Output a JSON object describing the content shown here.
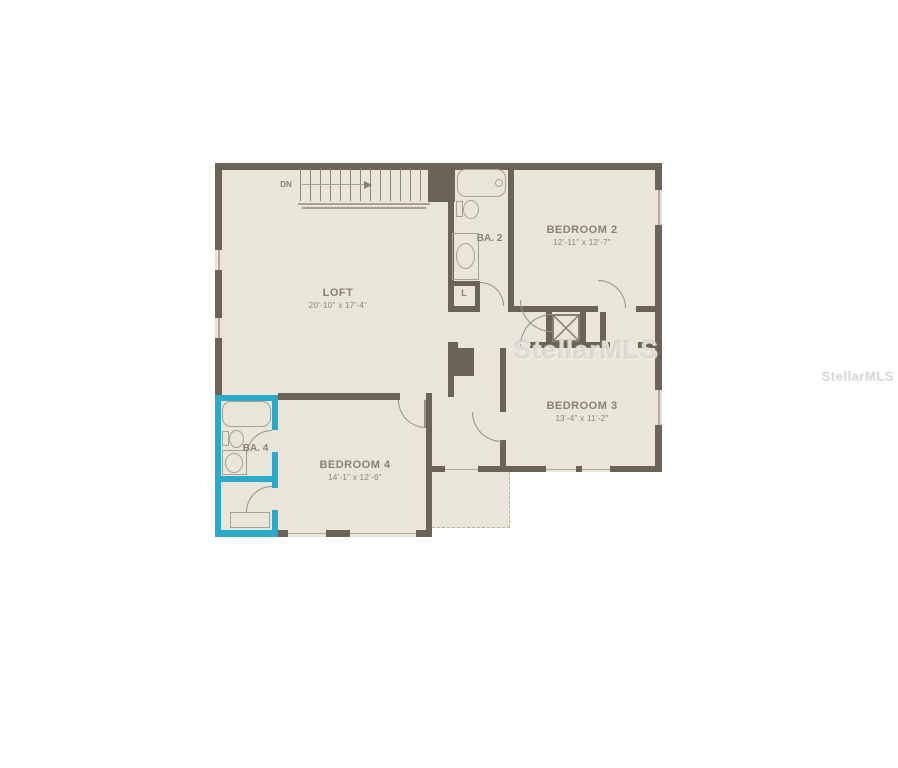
{
  "colors": {
    "background": "#ffffff",
    "wall": "#6b6355",
    "floor": "#e9e5d9",
    "fixture_line": "#a9a092",
    "label_text": "#8a8274",
    "highlight_teal": "#2ba9c9",
    "watermark": "#d7d5ce"
  },
  "rooms": {
    "loft": {
      "name": "LOFT",
      "dims": "20'-10\" x 17'-4\""
    },
    "bedroom2": {
      "name": "BEDROOM 2",
      "dims": "12'-11\" x 12'-7\""
    },
    "bedroom3": {
      "name": "BEDROOM 3",
      "dims": "13'-4\" x 11'-2\""
    },
    "bedroom4": {
      "name": "BEDROOM 4",
      "dims": "14'-1\" x 12'-6\""
    },
    "bath2": {
      "name": "BA. 2"
    },
    "bath4": {
      "name": "BA. 4"
    },
    "linen": {
      "name": "L"
    }
  },
  "stairs": {
    "label": "DN"
  },
  "watermarks": {
    "center": "StellarMLS",
    "right": "StellarMLS"
  }
}
